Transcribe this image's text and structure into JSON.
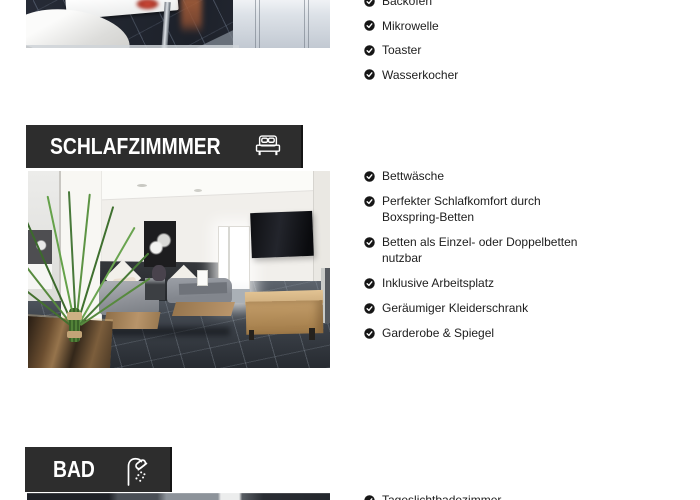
{
  "theme": {
    "page_bg": "#ffffff",
    "header_bg": "#2d2d2d",
    "header_text": "#ffffff",
    "text_color": "#1d1d1d",
    "check_bg": "#161616",
    "check_mark": "#ffffff"
  },
  "sections": {
    "kitchen": {
      "items": [
        "Backofen",
        "Mikrowelle",
        "Toaster",
        "Wasserkocher"
      ]
    },
    "bedroom": {
      "title": "SCHLAFZIMMMER",
      "icon": "bed-icon",
      "items": [
        "Bettwäsche",
        "Perfekter Schlafkomfort durch\nBoxspring-Betten",
        "Betten als Einzel- oder Doppelbetten\nnutzbar",
        "Inklusive Arbeitsplatz",
        "Geräumiger Kleiderschrank",
        "Garderobe & Spiegel"
      ]
    },
    "bathroom": {
      "title": "BAD",
      "icon": "shower-icon",
      "items": [
        "Tageslichtbadezimmer"
      ]
    }
  }
}
